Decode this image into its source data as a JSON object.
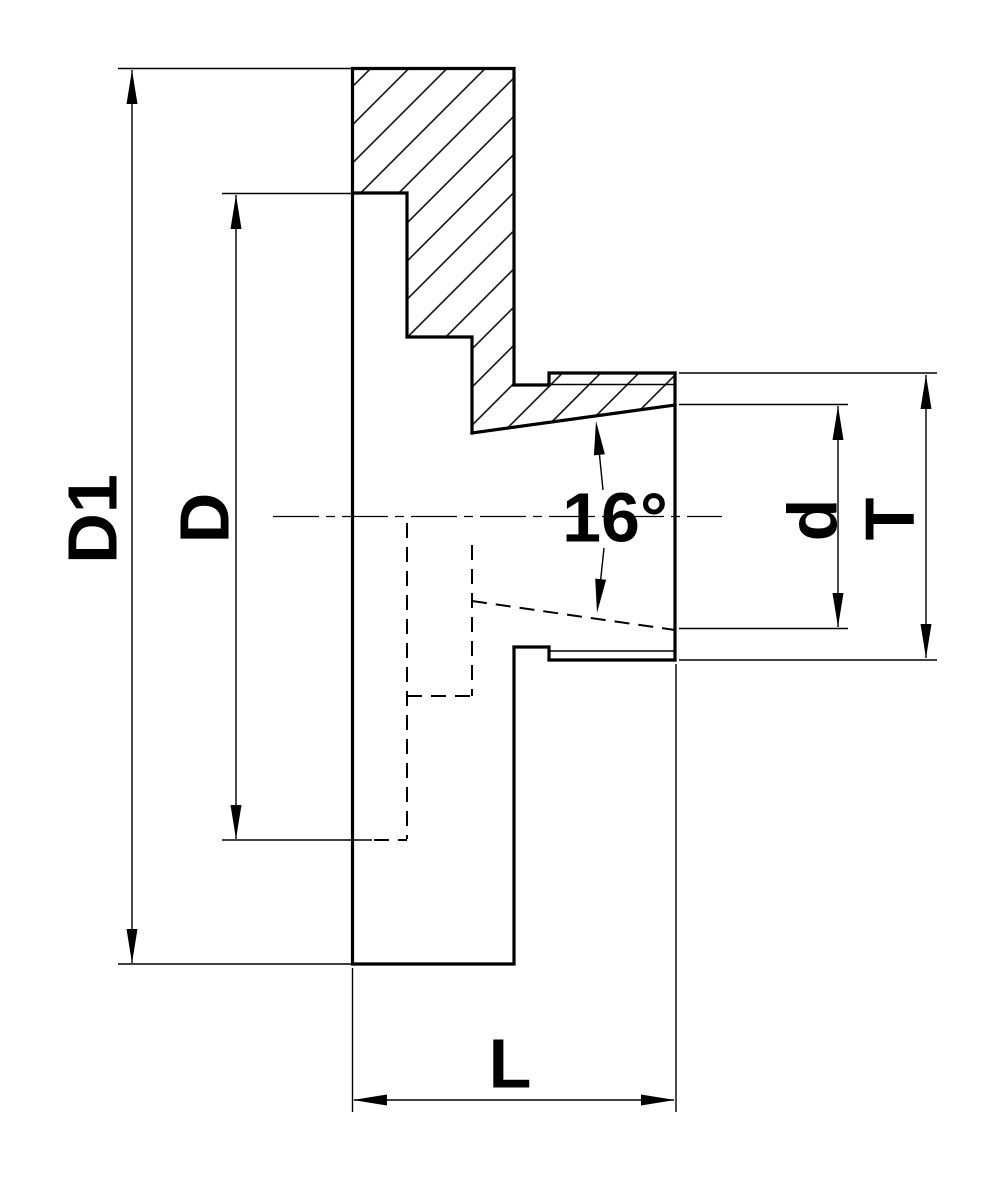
{
  "drawing": {
    "kind": "technical-section-drawing",
    "subject": "threaded backplate flange with 16-degree tapered bore, half section view",
    "line_color": "#000000",
    "background_color": "#ffffff"
  },
  "labels": {
    "outer_diameter": "D1",
    "recess_diameter": "D",
    "bore_mouth_diameter": "d",
    "thread_diameter": "T",
    "overall_length": "L",
    "taper_angle": "16°"
  }
}
